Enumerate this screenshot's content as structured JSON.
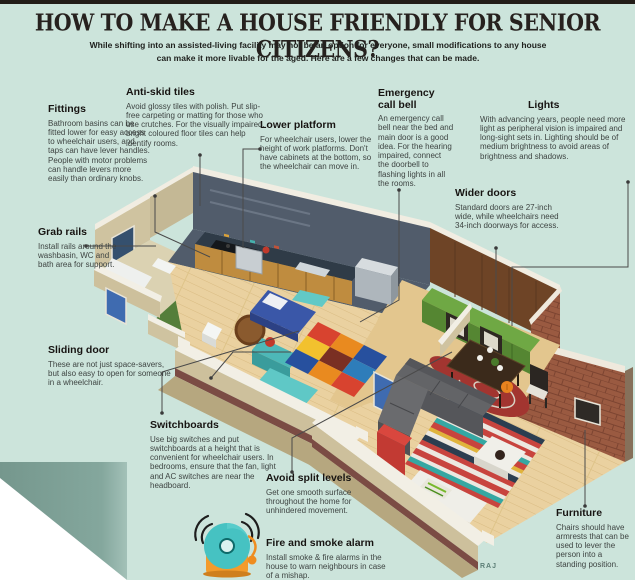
{
  "header": {
    "title": "HOW TO MAKE A HOUSE FRIENDLY FOR SENIOR CITIZENS?",
    "subtitle": "While shifting into an assisted-living facility may not be an option for everyone, small modifications to any house can make it more livable for the aged. Here are a few changes that can be made."
  },
  "callouts": [
    {
      "id": "fittings",
      "heading": "Fittings",
      "body": "Bathroom basins can be fitted lower for easy access to wheelchair users, and taps can have lever handles. People with motor problems can handle levers more easily than ordinary knobs."
    },
    {
      "id": "anti-skid-tiles",
      "heading": "Anti-skid tiles",
      "body": "Avoid glossy tiles with polish. Put slip-free carpeting or matting for those who use crutches. For the visually impaired, bright coloured floor tiles can help identify rooms."
    },
    {
      "id": "lower-platform",
      "heading": "Lower platform",
      "body": "For wheelchair users, lower the height of work platforms. Don't have cabinets at the bottom, so the wheelchair can move in."
    },
    {
      "id": "emergency-call-bell",
      "heading": "Emergency call bell",
      "body": "An emergency call bell near the bed and main door is a good idea. For the hearing impaired, connect the doorbell to flashing lights in all the rooms."
    },
    {
      "id": "lights",
      "heading": "Lights",
      "body": "With advancing years, people need more light as peripheral vision is impaired and long-sight sets in. Lighting should be of medium brightness to avoid areas of brightness and shadows."
    },
    {
      "id": "wider-doors",
      "heading": "Wider doors",
      "body": "Standard doors are 27-inch wide, while wheelchairs need 34-inch doorways for access."
    },
    {
      "id": "grab-rails",
      "heading": "Grab rails",
      "body": "Install rails around the washbasin, WC and bath area for support."
    },
    {
      "id": "sliding-door",
      "heading": "Sliding door",
      "body": "These are not just space-savers, but also easy to open for someone in a wheelchair."
    },
    {
      "id": "switchboards",
      "heading": "Switchboards",
      "body": "Use big switches and put switchboards at a height that is convenient for wheelchair users. In bedrooms, ensure that the fan, light and AC switches are near the headboard."
    },
    {
      "id": "avoid-split-levels",
      "heading": "Avoid split levels",
      "body": "Get one smooth surface throughout the home for unhindered movement."
    },
    {
      "id": "fire-and-smoke-alarm",
      "heading": "Fire and smoke alarm",
      "body": "Install smoke & fire alarms in the house to warn neighbours in case of a mishap."
    },
    {
      "id": "furniture",
      "heading": "Furniture",
      "body": "Chairs should have armrests that can be used to lever the person into a standing position."
    }
  ],
  "credit": "RAJ",
  "icons": {
    "fire_bell": "fire-alarm-bell-icon"
  },
  "colors": {
    "background": "#cce4db",
    "corner_sage": "#7fa399",
    "title_text": "#26211e",
    "body_text": "#3e4442",
    "bell_teal": "#46c2c2",
    "bell_orange": "#f39b2b",
    "wall_tan": "#cfc3a0",
    "brick": "#9a5a41",
    "wood_floor": "#ead1a0",
    "bath_green": "#547e3a",
    "kitchen_slate": "#515c6b"
  }
}
